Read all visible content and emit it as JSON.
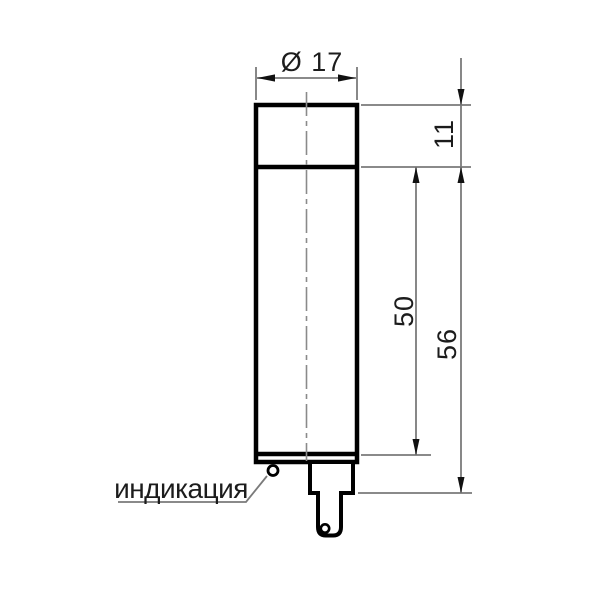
{
  "drawing": {
    "type": "technical-dimension-drawing",
    "labels": {
      "diameter": "Ø 17",
      "head_height": "11",
      "body_length": "50",
      "overall_length": "56",
      "indication": "индикация"
    },
    "dimensions": {
      "diameter_mm": 17,
      "head_height_mm": 11,
      "body_length_mm": 50,
      "overall_length_mm": 56
    },
    "colors": {
      "outline": "#000000",
      "thin_line": "#7a7a7a",
      "centerline": "#8a8a8a",
      "arrow": "#111111",
      "text": "#1c1c1c",
      "background": "#ffffff"
    }
  }
}
